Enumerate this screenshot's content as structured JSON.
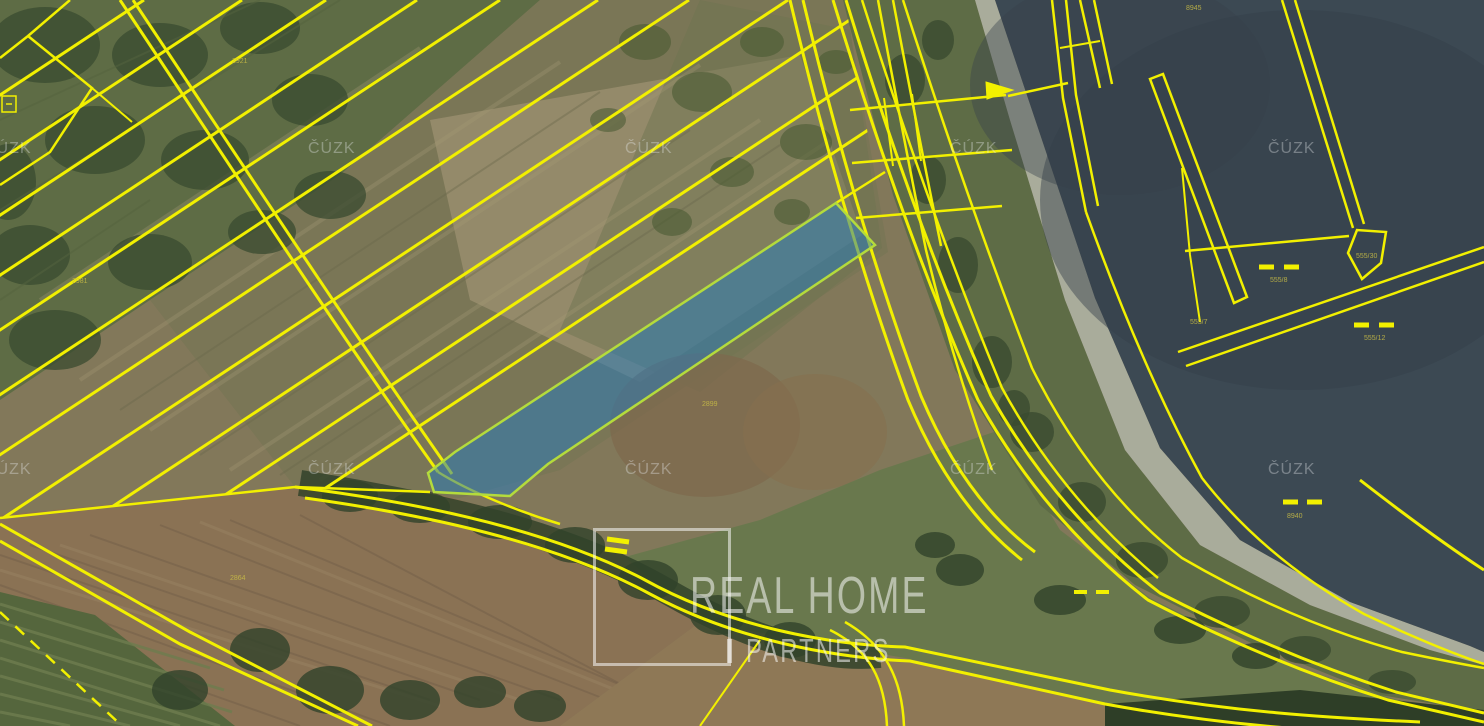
{
  "logo": {
    "line1": "REAL HOME",
    "line2": "PARTNERS",
    "separator": "|"
  },
  "watermarks": {
    "text": "ČÚZK",
    "positions": [
      [
        -16,
        140
      ],
      [
        308,
        140
      ],
      [
        625,
        140
      ],
      [
        950,
        140
      ],
      [
        1268,
        140
      ],
      [
        -16,
        461
      ],
      [
        308,
        461
      ],
      [
        625,
        461
      ],
      [
        950,
        461
      ],
      [
        1268,
        461
      ]
    ]
  },
  "colors": {
    "parcel_line": "#F2F000",
    "highlight_fill": "rgba(38,122,188,0.52)",
    "highlight_stroke": "#B4DB3C",
    "water": "#3C4953",
    "label_text": "#C9BD45"
  },
  "parcel_labels": [
    {
      "text": "2921",
      "x": 232,
      "y": 63
    },
    {
      "text": "2981",
      "x": 72,
      "y": 283
    },
    {
      "text": "2899",
      "x": 702,
      "y": 406
    },
    {
      "text": "2864",
      "x": 230,
      "y": 580
    },
    {
      "text": "8945",
      "x": 1186,
      "y": 10
    },
    {
      "text": "8940",
      "x": 1287,
      "y": 518
    },
    {
      "text": "555/8",
      "x": 1270,
      "y": 282
    },
    {
      "text": "555/12",
      "x": 1364,
      "y": 340
    },
    {
      "text": "555/30",
      "x": 1356,
      "y": 258
    },
    {
      "text": "555/7",
      "x": 1190,
      "y": 324
    }
  ],
  "map": {
    "width": 1484,
    "height": 726,
    "clip_diag": "0,0 845,0 888,252 460,498 295,487 0,518",
    "terrain": [
      {
        "t": "rect",
        "x": 0,
        "y": 0,
        "wd": 1484,
        "h": 726,
        "f": "#82785A"
      },
      {
        "t": "poly",
        "p": "0,0 540,0 340,175 150,300 0,400",
        "f": "#5E6C45"
      },
      {
        "t": "poly",
        "p": "540,0 845,0 888,252 560,470 460,498 295,487 150,300 340,175",
        "f": "#7A7656"
      },
      {
        "t": "poly",
        "p": "430,120 800,55 862,235 640,382 470,300",
        "f": "#9D9272",
        "o": 0.75
      },
      {
        "t": "poly",
        "p": "560,330 700,392 882,248 850,30 700,0",
        "f": "#6E7450",
        "o": 0.5
      },
      {
        "t": "lines",
        "s": "#A79C77",
        "w": 4,
        "o": 0.3,
        "segs": [
          [
            150,
            430,
            700,
            65
          ],
          [
            230,
            470,
            760,
            120
          ],
          [
            80,
            380,
            560,
            62
          ],
          [
            320,
            480,
            830,
            140
          ],
          [
            40,
            300,
            420,
            48
          ]
        ]
      },
      {
        "t": "lines",
        "s": "#6A684C",
        "w": 2,
        "o": 0.4,
        "segs": [
          [
            200,
            455,
            690,
            130
          ],
          [
            120,
            410,
            600,
            92
          ],
          [
            280,
            475,
            780,
            145
          ]
        ]
      },
      {
        "t": "ell",
        "cx": 705,
        "cy": 425,
        "rx": 95,
        "ry": 72,
        "f": "#7E6A4E",
        "o": 0.75
      },
      {
        "t": "ell",
        "cx": 815,
        "cy": 432,
        "rx": 72,
        "ry": 58,
        "f": "#85704F",
        "o": 0.6
      },
      {
        "t": "blobs",
        "f": "#3A4B30",
        "o": 0.75,
        "pts": [
          [
            45,
            45,
            55,
            38
          ],
          [
            160,
            55,
            48,
            32
          ],
          [
            260,
            28,
            40,
            26
          ],
          [
            95,
            140,
            50,
            34
          ],
          [
            205,
            160,
            44,
            30
          ],
          [
            310,
            100,
            38,
            26
          ],
          [
            30,
            255,
            40,
            30
          ],
          [
            150,
            262,
            42,
            28
          ],
          [
            330,
            195,
            36,
            24
          ],
          [
            262,
            232,
            34,
            22
          ],
          [
            55,
            340,
            46,
            30
          ],
          [
            8,
            182,
            28,
            38
          ]
        ]
      },
      {
        "t": "blobs",
        "f": "#46572F",
        "o": 0.55,
        "pts": [
          [
            645,
            42,
            26,
            18
          ],
          [
            702,
            92,
            30,
            20
          ],
          [
            762,
            42,
            22,
            15
          ],
          [
            806,
            142,
            26,
            18
          ],
          [
            732,
            172,
            22,
            15
          ],
          [
            672,
            222,
            20,
            14
          ],
          [
            792,
            212,
            18,
            13
          ],
          [
            836,
            62,
            18,
            12
          ],
          [
            608,
            120,
            18,
            12
          ]
        ]
      },
      {
        "t": "poly",
        "p": "0,515 295,487 430,492 520,516 625,557 700,622 560,726 0,726",
        "f": "#8A7254"
      },
      {
        "t": "lines",
        "s": "#74604A",
        "w": 2,
        "o": 0.5,
        "segs": [
          [
            0,
            555,
            430,
            700
          ],
          [
            0,
            585,
            390,
            726
          ],
          [
            0,
            620,
            300,
            726
          ],
          [
            30,
            545,
            480,
            700
          ],
          [
            90,
            535,
            560,
            700
          ],
          [
            160,
            525,
            620,
            705
          ],
          [
            230,
            520,
            680,
            710
          ],
          [
            300,
            515,
            700,
            726
          ]
        ]
      },
      {
        "t": "lines",
        "s": "#A28E6B",
        "w": 3,
        "o": 0.3,
        "segs": [
          [
            0,
            570,
            440,
            706
          ],
          [
            60,
            545,
            520,
            700
          ],
          [
            200,
            522,
            660,
            708
          ]
        ]
      },
      {
        "t": "poly",
        "p": "560,726 700,622 910,662 1105,704 1105,726",
        "f": "#8E7856"
      },
      {
        "t": "poly",
        "p": "1000,430 1060,530 1150,598 1270,658 1390,698 1484,720 1484,726 1110,726 1105,704 905,658 700,622 625,557 760,520 880,470",
        "f": "#69784D"
      },
      {
        "t": "poly",
        "p": "843,0 975,0 1010,120 1065,300 1125,450 1200,545 1310,605 1430,650 1484,665 1484,712 1380,695 1255,645 1135,585 1040,505 955,370 893,195",
        "f": "#5E6C46"
      },
      {
        "t": "poly",
        "p": "975,0 995,0 1038,128 1095,298 1160,448 1240,540 1350,602 1470,646 1484,652 1484,665 1430,650 1310,605 1200,545 1125,450 1065,300 1010,120",
        "f": "#A9AC9B"
      },
      {
        "t": "poly",
        "p": "995,0 1484,0 1484,652 1470,646 1350,602 1240,540 1160,448 1095,298 1038,128",
        "f": "#3C4953"
      },
      {
        "t": "ell",
        "cx": 1300,
        "cy": 200,
        "rx": 260,
        "ry": 190,
        "f": "#333F49",
        "o": 0.45
      },
      {
        "t": "ell",
        "cx": 1120,
        "cy": 85,
        "rx": 150,
        "ry": 110,
        "f": "#36424C",
        "o": 0.4
      },
      {
        "t": "blobs",
        "f": "#394B30",
        "o": 0.8,
        "pts": [
          [
            905,
            80,
            20,
            26
          ],
          [
            928,
            180,
            18,
            24
          ],
          [
            958,
            265,
            20,
            28
          ],
          [
            992,
            362,
            20,
            26
          ],
          [
            1032,
            432,
            22,
            20
          ],
          [
            1082,
            502,
            24,
            20
          ],
          [
            1142,
            560,
            26,
            18
          ],
          [
            1222,
            612,
            28,
            16
          ],
          [
            1305,
            650,
            26,
            14
          ],
          [
            938,
            40,
            16,
            20
          ],
          [
            1014,
            408,
            16,
            18
          ],
          [
            1392,
            682,
            24,
            12
          ]
        ]
      },
      {
        "t": "poly",
        "p": "1105,726 1105,704 1300,690 1484,710 1484,726",
        "f": "#2E3E27"
      },
      {
        "t": "poly",
        "p": "0,592 95,615 235,726 0,726",
        "f": "#55663D"
      },
      {
        "t": "lines",
        "s": "#6E7D4F",
        "w": 3,
        "o": 0.8,
        "segs": [
          [
            0,
            604,
            210,
            668
          ],
          [
            0,
            622,
            224,
            690
          ],
          [
            0,
            640,
            232,
            712
          ],
          [
            0,
            658,
            220,
            726
          ],
          [
            0,
            676,
            180,
            726
          ],
          [
            0,
            694,
            130,
            726
          ],
          [
            0,
            712,
            70,
            726
          ]
        ]
      },
      {
        "t": "path",
        "d": "M300,483 C450,507 570,535 668,592 C760,645 830,660 880,655",
        "s": "#33432A",
        "w": 26,
        "o": 0.85
      },
      {
        "t": "blobs",
        "f": "#31422A",
        "o": 0.8,
        "pts": [
          [
            350,
            496,
            28,
            16
          ],
          [
            420,
            507,
            30,
            16
          ],
          [
            500,
            522,
            32,
            17
          ],
          [
            575,
            545,
            30,
            18
          ],
          [
            648,
            580,
            30,
            20
          ],
          [
            718,
            615,
            28,
            20
          ],
          [
            790,
            640,
            26,
            18
          ],
          [
            960,
            570,
            24,
            16
          ],
          [
            1060,
            600,
            26,
            15
          ],
          [
            260,
            650,
            30,
            22
          ],
          [
            330,
            690,
            34,
            24
          ],
          [
            180,
            690,
            28,
            20
          ],
          [
            410,
            700,
            30,
            20
          ],
          [
            480,
            692,
            26,
            16
          ],
          [
            540,
            706,
            26,
            16
          ],
          [
            935,
            545,
            20,
            13
          ],
          [
            1180,
            630,
            26,
            14
          ],
          [
            1256,
            656,
            24,
            13
          ]
        ]
      },
      {
        "t": "lines",
        "s": "#55643F",
        "w": 2,
        "o": 0.5,
        "segs": [
          [
            0,
            120,
            260,
            0
          ],
          [
            0,
            210,
            340,
            0
          ],
          [
            0,
            300,
            150,
            200
          ]
        ]
      }
    ],
    "cadastre": [
      {
        "t": "line",
        "x1": 144,
        "y1": 0,
        "x2": -956,
        "y2": 726,
        "c": 1
      },
      {
        "t": "line",
        "x1": 242,
        "y1": 0,
        "x2": -858,
        "y2": 726,
        "c": 1
      },
      {
        "t": "line",
        "x1": 326,
        "y1": 0,
        "x2": -774,
        "y2": 726,
        "c": 1
      },
      {
        "t": "line",
        "x1": 417,
        "y1": 0,
        "x2": -683,
        "y2": 726,
        "c": 1
      },
      {
        "t": "line",
        "x1": 500,
        "y1": 0,
        "x2": -600,
        "y2": 726,
        "c": 1
      },
      {
        "t": "line",
        "x1": 598,
        "y1": 0,
        "x2": -502,
        "y2": 726,
        "c": 1
      },
      {
        "t": "line",
        "x1": 689,
        "y1": 0,
        "x2": -411,
        "y2": 726,
        "c": 1
      },
      {
        "t": "line",
        "x1": 788,
        "y1": 0,
        "x2": -312,
        "y2": 726,
        "c": 1
      },
      {
        "t": "line",
        "x1": 880,
        "y1": 0,
        "x2": -220,
        "y2": 726,
        "c": 1
      },
      {
        "t": "line",
        "x1": 975,
        "y1": 0,
        "x2": -125,
        "y2": 726,
        "c": 1
      },
      {
        "t": "line",
        "x1": 1065,
        "y1": 0,
        "x2": -35,
        "y2": 726,
        "c": 1
      },
      {
        "t": "path",
        "d": "M70,0 L28,36 L0,58",
        "w": 2.5
      },
      {
        "t": "path",
        "d": "M28,36 L92,88 L50,152 L0,185",
        "w": 2.5
      },
      {
        "t": "path",
        "d": "M92,88 L132,122",
        "w": 2
      },
      {
        "t": "path",
        "d": "M2,96 h14 v16 h-14 z M6,104 h6",
        "w": 1.5
      },
      {
        "t": "path",
        "d": "M120,0 C220,150 330,320 438,472",
        "w": 3
      },
      {
        "t": "path",
        "d": "M133,0 C233,150 343,318 452,474",
        "w": 3
      },
      {
        "t": "path",
        "d": "M0,518 L295,487 L430,492",
        "w": 2.5
      },
      {
        "t": "path",
        "d": "M0,524 L190,632 L372,726",
        "w": 3
      },
      {
        "t": "path",
        "d": "M0,541 L180,644 L358,726",
        "w": 3
      },
      {
        "t": "path",
        "d": "M0,612 L122,726",
        "w": 2.5,
        "dash": "12 9"
      },
      {
        "t": "path",
        "d": "M295,487 C440,505 560,535 645,580 C730,627 830,645 905,647 L1110,690 C1230,712 1330,718 1420,722",
        "w": 3
      },
      {
        "t": "path",
        "d": "M305,498 C450,518 565,548 650,594 C735,640 835,658 910,661 L1105,704 C1225,726 1320,731 1400,735",
        "w": 3
      },
      {
        "t": "path",
        "d": "M438,472 C470,492 520,512 560,524",
        "w": 2.5
      },
      {
        "t": "path",
        "d": "M830,630 C870,650 885,680 887,726",
        "w": 2.5
      },
      {
        "t": "path",
        "d": "M845,622 C885,645 902,678 904,726",
        "w": 2.5
      },
      {
        "t": "path",
        "d": "M760,640 L700,726",
        "w": 2
      },
      {
        "t": "path",
        "d": "M833,0 Q903,230 978,400 Q1045,520 1148,600 Q1268,662 1388,700 L1484,722",
        "w": 3
      },
      {
        "t": "path",
        "d": "M846,0 Q916,228 991,396 Q1058,514 1160,593 Q1278,654 1396,692 L1484,713",
        "w": 3
      },
      {
        "t": "path",
        "d": "M862,0 Q932,220 1002,388 Q1062,498 1158,578",
        "w": 2.5
      },
      {
        "t": "path",
        "d": "M903,0 Q967,200 1032,368 Q1092,488 1182,558 Q1292,622 1402,652 Q1450,662 1484,668",
        "w": 2.5
      },
      {
        "t": "path",
        "d": "M790,0 Q842,220 908,400 Q952,505 1022,560",
        "w": 3
      },
      {
        "t": "path",
        "d": "M803,0 Q855,218 921,396 Q965,500 1035,552",
        "w": 3
      },
      {
        "t": "path",
        "d": "M878,0 Q902,130 926,250 Q955,370 992,470",
        "w": 2.5
      },
      {
        "t": "path",
        "d": "M893,0 Q917,128 941,246",
        "w": 2.5
      },
      {
        "t": "path",
        "d": "M850,110 L1006,95",
        "w": 2.5
      },
      {
        "t": "path",
        "d": "M852,163 L1012,150",
        "w": 2.5
      },
      {
        "t": "path",
        "d": "M856,218 L1002,206",
        "w": 2.5
      },
      {
        "t": "path",
        "d": "M884,98 L893,166 M912,94 L921,161",
        "w": 2
      },
      {
        "t": "path",
        "d": "M1008,96 L1068,83",
        "w": 2.5
      },
      {
        "t": "path",
        "d": "M836,203 L885,172",
        "w": 2.5
      },
      {
        "t": "path",
        "d": "M1052,0 L1063,98 L1086,212",
        "w": 2.5
      },
      {
        "t": "path",
        "d": "M1066,0 L1076,95 L1098,206",
        "w": 2.5
      },
      {
        "t": "path",
        "d": "M1060,48 L1100,41",
        "w": 2
      },
      {
        "t": "path",
        "d": "M1080,0 L1100,88",
        "w": 2.5
      },
      {
        "t": "path",
        "d": "M1094,0 L1112,84",
        "w": 2.5
      },
      {
        "t": "path",
        "d": "M1086,212 Q1142,368 1202,478 Q1264,558 1364,614 Q1436,648 1484,664",
        "w": 2.5
      },
      {
        "t": "poly",
        "p": "1150,79 1163,74 1247,297 1234,303",
        "w": 2.5
      },
      {
        "t": "path",
        "d": "M1282,0 L1353,228",
        "w": 2.5
      },
      {
        "t": "path",
        "d": "M1295,0 L1364,224",
        "w": 2.5
      },
      {
        "t": "poly",
        "p": "1348,253 1357,230 1386,232 1381,263 1362,279",
        "w": 2.5
      },
      {
        "t": "path",
        "d": "M1185,251 L1349,236",
        "w": 2.5
      },
      {
        "t": "path",
        "d": "M1182,168 L1190,255 L1200,322",
        "w": 2
      },
      {
        "t": "path",
        "d": "M1178,352 L1484,247",
        "w": 2.5
      },
      {
        "t": "path",
        "d": "M1186,366 L1484,262",
        "w": 2.5
      },
      {
        "t": "path",
        "d": "M1360,480 Q1432,536 1484,570",
        "w": 3
      },
      {
        "t": "poly",
        "p": "986,82 1013,90 987,99",
        "f": "#F2F000",
        "w": 1
      },
      {
        "t": "path",
        "d": "M607,539 l22,3 M605,549 l22,3",
        "w": 5
      },
      {
        "t": "path",
        "d": "M1283,502 h15 M1307,502 h15",
        "w": 5
      },
      {
        "t": "path",
        "d": "M1259,267 h15 M1284,267 h15",
        "w": 5
      },
      {
        "t": "path",
        "d": "M1354,325 h15 M1379,325 h15",
        "w": 5
      },
      {
        "t": "path",
        "d": "M1074,592 h13 M1096,592 h13",
        "w": 4
      }
    ],
    "highlight": {
      "points": "836,203 875,245 548,464 510,496 434,492 428,473 455,452"
    }
  }
}
